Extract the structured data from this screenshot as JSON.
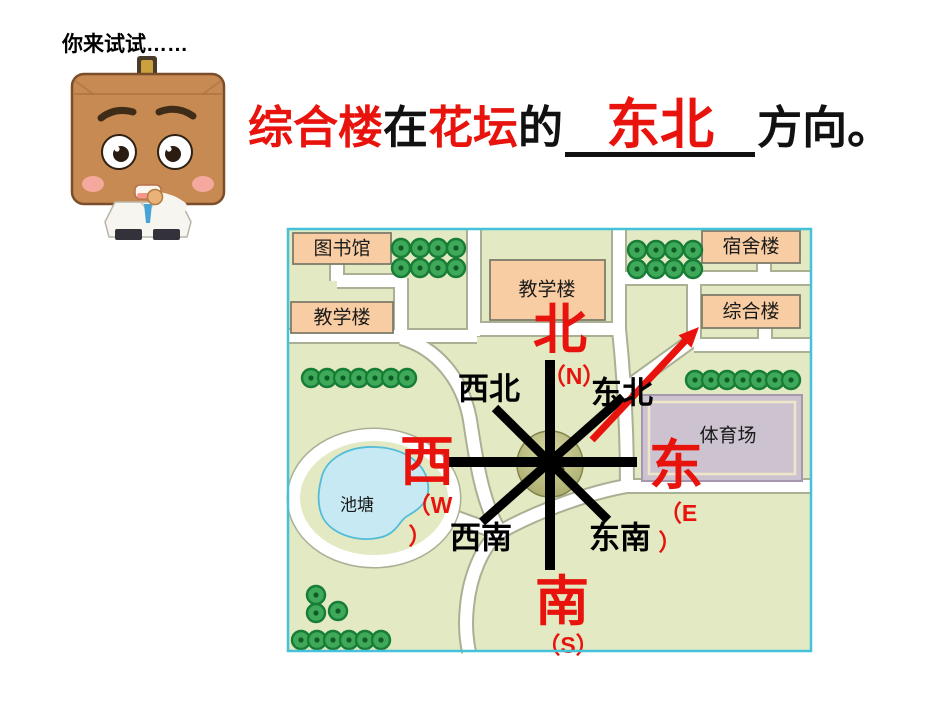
{
  "page": {
    "title": "你来试试……"
  },
  "question": {
    "subject": "综合楼",
    "verb": "在",
    "reference": "花坛",
    "particle": "的",
    "answer": "东北",
    "suffix": "方向。"
  },
  "map": {
    "buildings": [
      {
        "label": "图书馆"
      },
      {
        "label": "教学楼"
      },
      {
        "label": "教学楼"
      },
      {
        "label": "宿舍楼"
      },
      {
        "label": "综合楼"
      },
      {
        "label": "体育场"
      }
    ],
    "pond_label": "池塘",
    "flowerbed_label": "花坛",
    "compass": {
      "north": "北",
      "north_abbr": "（N）",
      "south": "南",
      "south_abbr": "（S）",
      "west": "西",
      "west_abbr_open": "（W",
      "west_abbr_close": "）",
      "east": "东",
      "east_abbr_open": "（E",
      "east_abbr_close": "）",
      "northwest": "西北",
      "northeast": "东北",
      "southwest": "西南",
      "southeast": "东南"
    }
  },
  "colors": {
    "accent_red": "#e8130c",
    "map_border": "#45c1da",
    "grass": "#e2e9c3",
    "road": "#ffffff",
    "building_fill": "#f9cda3",
    "stadium_fill": "#cdc3d0",
    "pond_fill": "#c6e9f4",
    "compass_black": "#000000"
  }
}
